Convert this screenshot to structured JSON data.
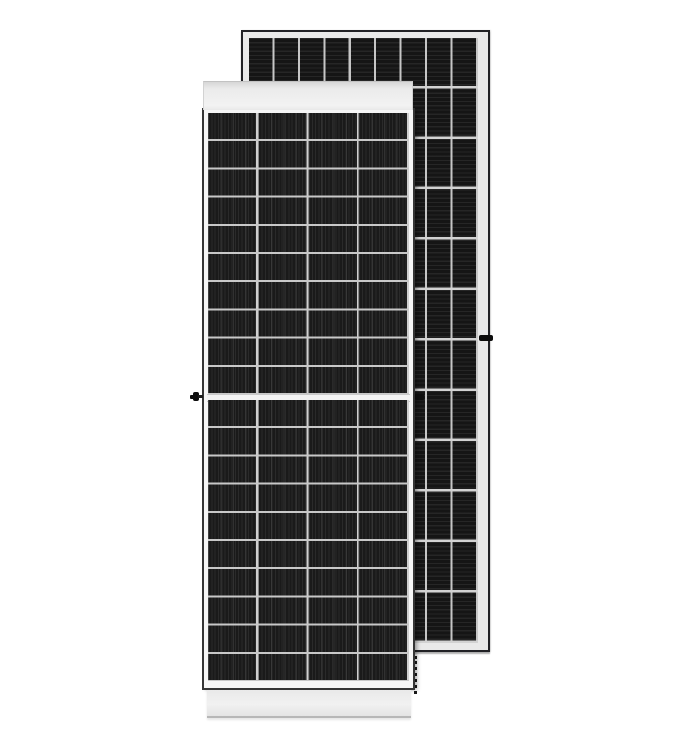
{
  "scene": {
    "title": "Product photo: two monocrystalline solar PV modules on white background",
    "background_color": "#ffffff",
    "front_panel": {
      "label": "Solar panel - front view with silver frame rails",
      "orientation": "portrait",
      "cell_columns": 4,
      "cell_rows_per_half": 10,
      "halves": 2,
      "half_cut_center_gap": true,
      "frame_color": "#ebebeb",
      "cell_color": "#1a1a1a",
      "grid_line_color": "#cccccc",
      "top_rail_label": "top frame rail",
      "bottom_rail_label": "bottom frame rail",
      "center_gap_label": "half-cell center gap",
      "knob_label": "grounding knob on left frame"
    },
    "rear_panel": {
      "label": "Solar panel - rear view, standing behind front panel",
      "orientation": "portrait",
      "cell_columns": 9,
      "cell_rows": 12,
      "margin_color": "#e9e9e9",
      "outline_color": "#212125",
      "cell_color": "#151515",
      "right_tab_label": "mounting tab on right frame",
      "left_tab_label": "mounting tab near front panel edge",
      "dotted_edge_label": "dashed shadow edge below rear panel"
    }
  }
}
